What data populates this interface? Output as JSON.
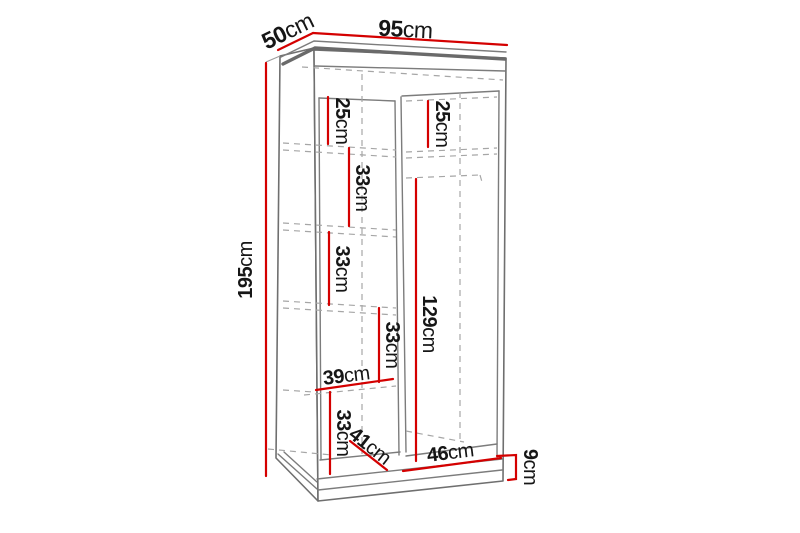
{
  "diagram": {
    "subject": "wardrobe-dimension-drawing",
    "colors": {
      "dimension_line": "#d40000",
      "structure_line": "#7c7c7c",
      "hidden_line": "#a6a6a6",
      "label_text": "#161616",
      "background": "#ffffff"
    },
    "dimensions": {
      "depth_top": {
        "num": "50",
        "unit": "cm"
      },
      "width_top": {
        "num": "95",
        "unit": "cm"
      },
      "height_left": {
        "num": "195",
        "unit": "cm"
      },
      "left_top_section": {
        "num": "25",
        "unit": "cm"
      },
      "right_top_section": {
        "num": "25",
        "unit": "cm"
      },
      "shelf_gap_1": {
        "num": "33",
        "unit": "cm"
      },
      "shelf_gap_2": {
        "num": "33",
        "unit": "cm"
      },
      "shelf_gap_3": {
        "num": "33",
        "unit": "cm"
      },
      "hanging_space": {
        "num": "129",
        "unit": "cm"
      },
      "left_inner_width": {
        "num": "39",
        "unit": "cm"
      },
      "bottom_section": {
        "num": "33",
        "unit": "cm"
      },
      "inner_depth": {
        "num": "41",
        "unit": "cm"
      },
      "right_inner_width": {
        "num": "46",
        "unit": "cm"
      },
      "plinth_height": {
        "num": "9",
        "unit": "cm"
      }
    }
  }
}
